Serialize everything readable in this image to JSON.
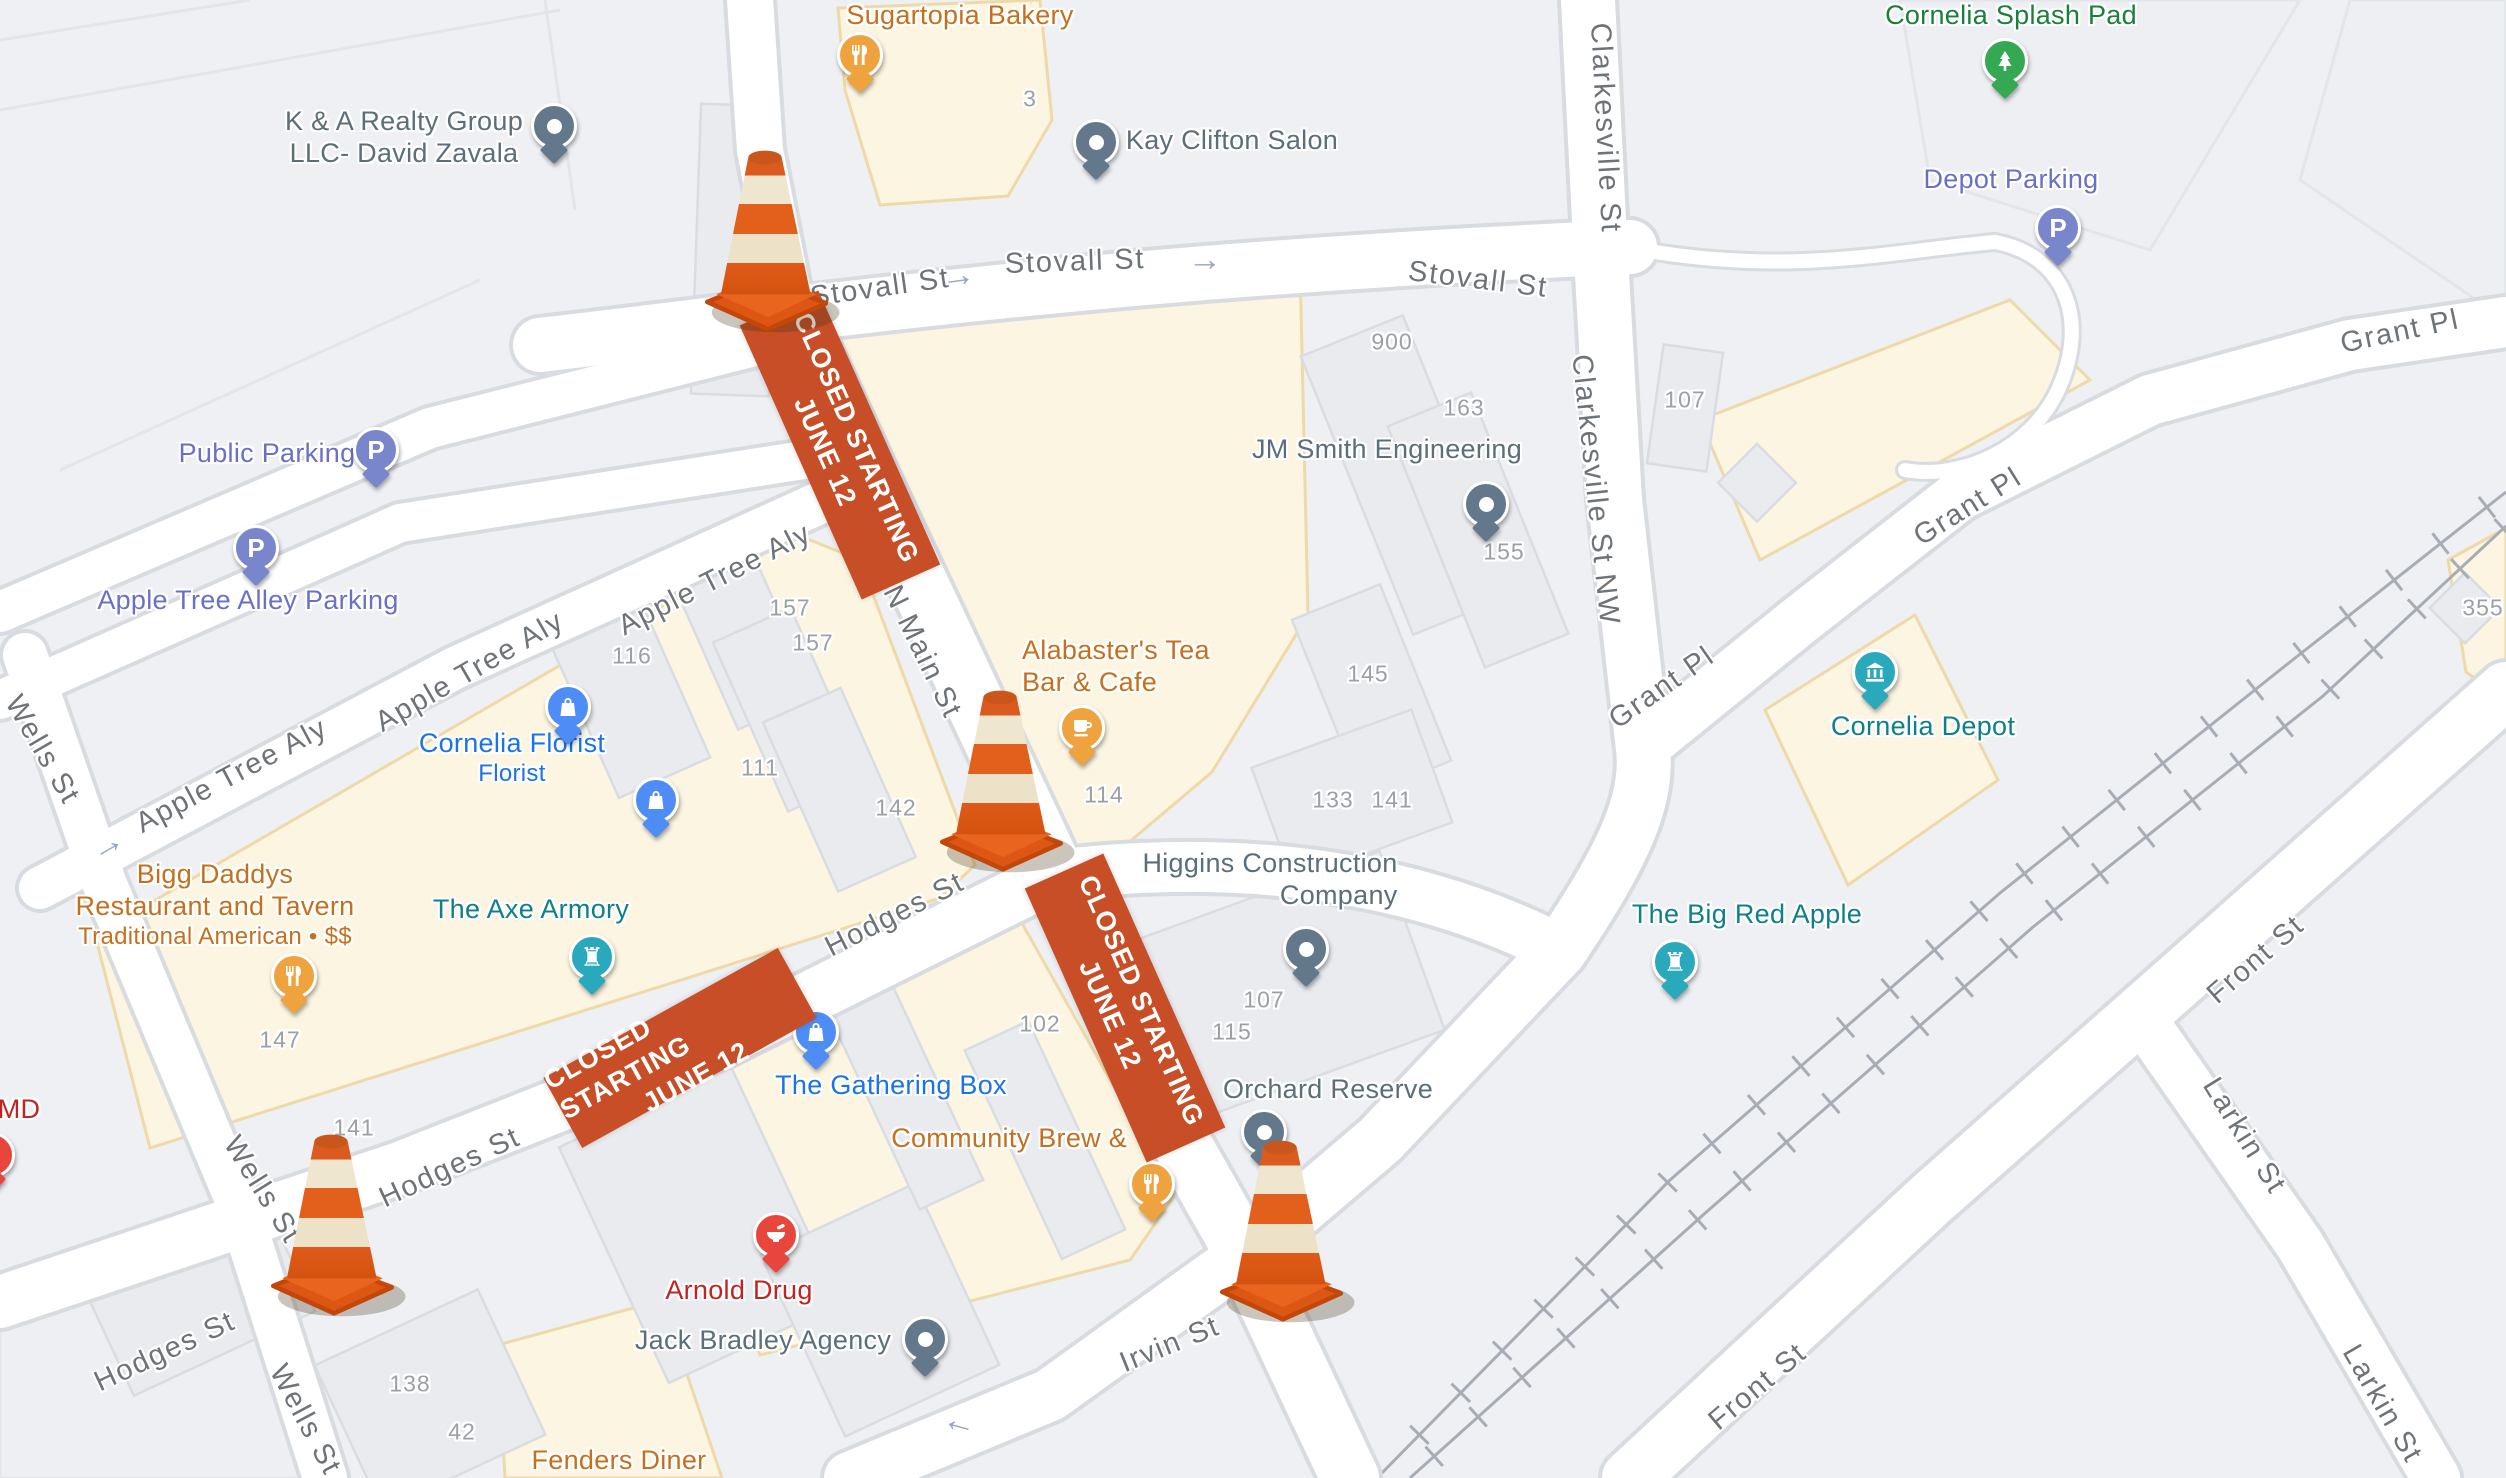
{
  "map_meta": {
    "closure_banner": {
      "line1": "CLOSED STARTING",
      "line2": "JUNE 12"
    },
    "colors": {
      "background": "#eef0f3",
      "road_fill": "#ffffff",
      "road_casing": "#d8dbe0",
      "commercial_area": "#fbf5e2",
      "commercial_border": "#efd9a8",
      "building_fill": "#e9ebef",
      "building_border": "#d9dce1",
      "banner_orange": "#c74e26",
      "cone_orange": "#e05617",
      "cone_cream": "#efe5cd",
      "street_label": "#6e7378",
      "number_label": "#9aa0a6",
      "food_poi": "#c5701d",
      "shop_poi": "#1a73e8",
      "attraction_poi": "#0d8089",
      "park_poi": "#188038",
      "parking_poi": "#6a6fc7",
      "business_poi": "#5b6e79",
      "pharmacy_poi": "#c5221f",
      "pin_gray": "#64788c",
      "pin_orange": "#efa33f",
      "pin_purple": "#7986cb",
      "pin_blue": "#4e8df5",
      "pin_teal": "#2ba9bc",
      "pin_green": "#34a853",
      "pin_red": "#e8453c"
    }
  },
  "streets": {
    "stovall": "Stovall St",
    "n_main": "N Main St",
    "hodges": "Hodges St",
    "apple_aly": "Apple Tree Aly",
    "wells": "Wells St",
    "clarkesville": "Clarkesville St",
    "clarkesville_nw": "Clarkesville St NW",
    "grant": "Grant Pl",
    "irvin": "Irvin St",
    "front": "Front St",
    "larkin": "Larkin St"
  },
  "icons": {
    "arrow_right": "→",
    "arrow_left": "←"
  },
  "pois": {
    "kna": {
      "line1": "K & A Realty Group",
      "line2": "LLC- David Zavala"
    },
    "sugartopia": {
      "name": "Sugartopia Bakery"
    },
    "kay_clifton": {
      "name": "Kay Clifton Salon"
    },
    "splash_pad": {
      "name": "Cornelia Splash Pad"
    },
    "depot_parking": {
      "name": "Depot Parking"
    },
    "public_parking": {
      "name": "Public Parking"
    },
    "apple_parking": {
      "name": "Apple Tree Alley Parking"
    },
    "jm_smith": {
      "name": "JM Smith Engineering"
    },
    "alabaster": {
      "line1": "Alabaster's Tea",
      "line2": "Bar & Cafe"
    },
    "cornelia_florist": {
      "name": "Cornelia Florist",
      "subtitle": "Florist"
    },
    "bigg_daddys": {
      "line1": "Bigg Daddys",
      "line2": "Restaurant and Tavern",
      "subtitle": "Traditional American • $$"
    },
    "axe_armory": {
      "name": "The Axe Armory"
    },
    "higgins": {
      "line1": "Higgins Construction",
      "line2": "Company"
    },
    "cornelia_depot": {
      "name": "Cornelia Depot"
    },
    "big_red_apple": {
      "name": "The Big Red Apple"
    },
    "gathering_box": {
      "name": "The Gathering Box"
    },
    "community_brew": {
      "name": "Community Brew & Tap"
    },
    "orchard_reserve": {
      "name": "Orchard Reserve"
    },
    "arnold_drug": {
      "name": "Arnold Drug"
    },
    "jack_bradley": {
      "name": "Jack Bradley Agency"
    },
    "fenders": {
      "name": "Fenders Diner"
    },
    "md_partial": {
      "name": "MD"
    }
  },
  "building_numbers": [
    "3",
    "900",
    "163",
    "107",
    "355",
    "157",
    "157",
    "116",
    "111",
    "142",
    "114",
    "145",
    "133",
    "141",
    "155",
    "107",
    "115",
    "102",
    "147",
    "141",
    "138",
    "42"
  ]
}
